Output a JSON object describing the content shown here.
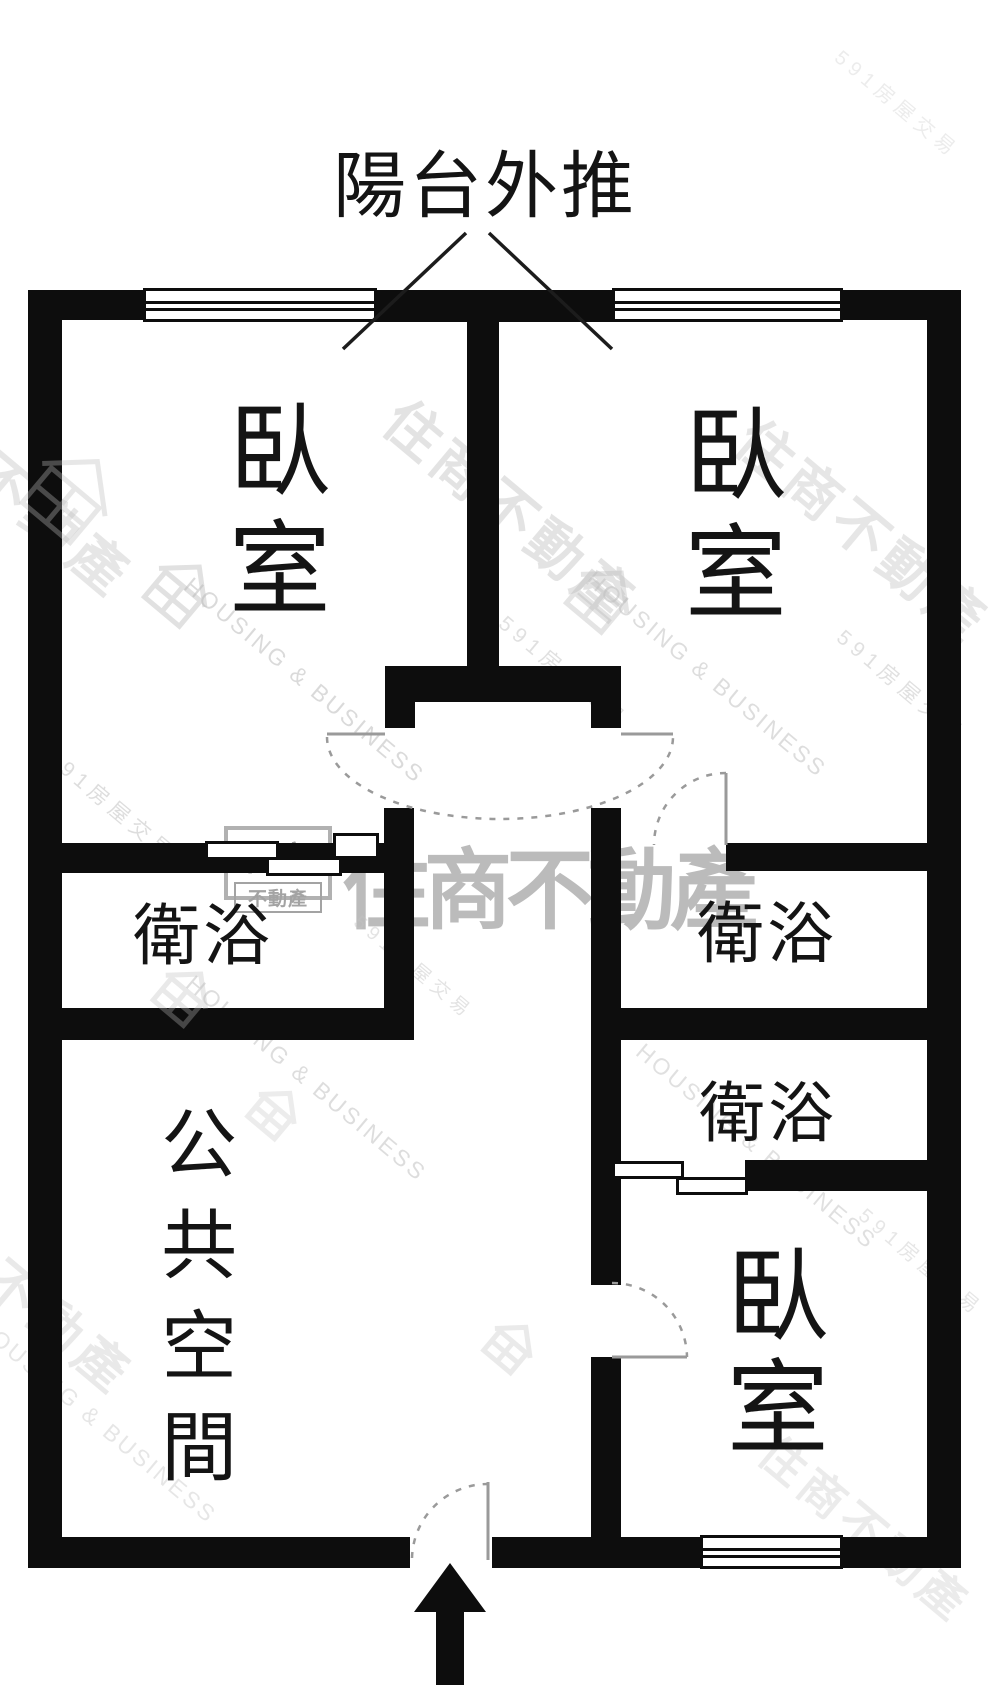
{
  "title": {
    "text": "陽台外推"
  },
  "brand_watermark": {
    "logo_top": "住商",
    "logo_bottom": "不動產",
    "big_text": "住商不動產",
    "company_en": "HOUSING & BUSINESS",
    "portal_text": "591房屋交易",
    "diagonal_text": "住商不動產",
    "gray_color": "#c3c3c3"
  },
  "rooms": {
    "bedroom1": {
      "label": "臥室"
    },
    "bedroom2": {
      "label": "臥室"
    },
    "bedroom3": {
      "label": "臥室"
    },
    "bath_left": {
      "label": "衛浴"
    },
    "bath_right_upper": {
      "label": "衛浴"
    },
    "bath_right_lower": {
      "label": "衛浴"
    },
    "public_space": {
      "label": "公共空間"
    }
  },
  "label_layout": [
    {
      "room": "bedroom1",
      "left": 214,
      "top": 397,
      "size": 102,
      "vertical": true,
      "spacing": 16
    },
    {
      "room": "bedroom2",
      "left": 670,
      "top": 401,
      "size": 102,
      "vertical": true,
      "spacing": 16
    },
    {
      "room": "bedroom3",
      "left": 712,
      "top": 1242,
      "size": 102,
      "vertical": true,
      "spacing": 10
    },
    {
      "room": "bath_left",
      "left": 133,
      "top": 899,
      "size": 67,
      "vertical": false,
      "spacing": 3
    },
    {
      "room": "bath_right_upper",
      "left": 697,
      "top": 897,
      "size": 67,
      "vertical": false,
      "spacing": 3
    },
    {
      "room": "bath_right_lower",
      "left": 699,
      "top": 1077,
      "size": 66,
      "vertical": false,
      "spacing": 3
    },
    {
      "room": "public_space",
      "left": 149,
      "top": 1104,
      "size": 76,
      "vertical": true,
      "spacing": 25
    }
  ],
  "floorplan": {
    "wall_color": "#0d0d0d",
    "walls": [
      {
        "x": 28,
        "y": 290,
        "w": 115,
        "h": 30
      },
      {
        "x": 377,
        "y": 290,
        "w": 235,
        "h": 32
      },
      {
        "x": 843,
        "y": 290,
        "w": 118,
        "h": 30
      },
      {
        "x": 28,
        "y": 290,
        "w": 34,
        "h": 1278
      },
      {
        "x": 927,
        "y": 290,
        "w": 34,
        "h": 1278
      },
      {
        "x": 28,
        "y": 1537,
        "w": 382,
        "h": 31
      },
      {
        "x": 492,
        "y": 1537,
        "w": 208,
        "h": 31
      },
      {
        "x": 843,
        "y": 1537,
        "w": 118,
        "h": 31
      },
      {
        "x": 467,
        "y": 318,
        "w": 32,
        "h": 352
      },
      {
        "x": 385,
        "y": 666,
        "w": 236,
        "h": 36
      },
      {
        "x": 385,
        "y": 700,
        "w": 30,
        "h": 28
      },
      {
        "x": 591,
        "y": 700,
        "w": 30,
        "h": 28
      },
      {
        "x": 62,
        "y": 843,
        "w": 272,
        "h": 30
      },
      {
        "x": 332,
        "y": 843,
        "w": 54,
        "h": 30
      },
      {
        "x": 384,
        "y": 808,
        "w": 30,
        "h": 232
      },
      {
        "x": 62,
        "y": 1008,
        "w": 352,
        "h": 32
      },
      {
        "x": 591,
        "y": 808,
        "w": 30,
        "h": 477
      },
      {
        "x": 591,
        "y": 1357,
        "w": 30,
        "h": 183
      },
      {
        "x": 726,
        "y": 843,
        "w": 201,
        "h": 28
      },
      {
        "x": 591,
        "y": 1008,
        "w": 336,
        "h": 32
      },
      {
        "x": 745,
        "y": 1160,
        "w": 182,
        "h": 31
      }
    ],
    "windows": [
      {
        "x": 143,
        "y": 288,
        "w": 234,
        "h": 34
      },
      {
        "x": 612,
        "y": 288,
        "w": 231,
        "h": 34
      },
      {
        "x": 700,
        "y": 1535,
        "w": 143,
        "h": 34
      }
    ],
    "sliding_panels": [
      {
        "x": 205,
        "y": 841,
        "w": 74,
        "h": 19
      },
      {
        "x": 266,
        "y": 857,
        "w": 76,
        "h": 19
      },
      {
        "x": 333,
        "y": 833,
        "w": 46,
        "h": 26
      },
      {
        "x": 612,
        "y": 1161,
        "w": 72,
        "h": 18
      },
      {
        "x": 676,
        "y": 1177,
        "w": 72,
        "h": 18
      }
    ],
    "door_leaves": [
      {
        "x1": 327,
        "y1": 734,
        "x2": 385,
        "y2": 734
      },
      {
        "x1": 621,
        "y1": 734,
        "x2": 673,
        "y2": 734
      },
      {
        "x1": 726,
        "y1": 773,
        "x2": 726,
        "y2": 845
      },
      {
        "x1": 612,
        "y1": 1357,
        "x2": 687,
        "y2": 1357
      },
      {
        "x1": 488,
        "y1": 1482,
        "x2": 488,
        "y2": 1560
      }
    ],
    "door_arcs": [
      {
        "d": "M327,737 A173,82 0 0 0 673,737"
      },
      {
        "d": "M726,773 A72,72 0 0 0 654,845"
      },
      {
        "d": "M612,1283 A75,75 0 0 1 687,1357"
      },
      {
        "d": "M412,1558 A76,76 0 0 1 488,1484"
      }
    ],
    "leader_lines": [
      {
        "x1": 343,
        "y1": 349,
        "x2": 466,
        "y2": 233
      },
      {
        "x1": 489,
        "y1": 233,
        "x2": 612,
        "y2": 349
      }
    ],
    "entry_arrow_points": "450,1563 486,1612 464,1612 464,1685 436,1685 436,1612 414,1612"
  },
  "watermarks": {
    "texts": [
      {
        "kind": "cjk",
        "left": 420,
        "top": 378,
        "size": 56,
        "rot": 40,
        "op": 0.45
      },
      {
        "kind": "cjk",
        "left": 772,
        "top": 398,
        "size": 56,
        "rot": 40,
        "op": 0.4
      },
      {
        "kind": "cjk",
        "left": -85,
        "top": 352,
        "size": 56,
        "rot": 40,
        "op": 0.4
      },
      {
        "kind": "cjk",
        "left": -70,
        "top": 1165,
        "size": 52,
        "rot": 40,
        "op": 0.35
      },
      {
        "kind": "cjk",
        "left": 788,
        "top": 1418,
        "size": 46,
        "rot": 40,
        "op": 0.32
      },
      {
        "kind": "en",
        "left": 196,
        "top": 572,
        "size": 23,
        "rot": 40,
        "op": 0.6
      },
      {
        "kind": "en",
        "left": 598,
        "top": 566,
        "size": 23,
        "rot": 40,
        "op": 0.55
      },
      {
        "kind": "en",
        "left": 198,
        "top": 970,
        "size": 23,
        "rot": 40,
        "op": 0.55
      },
      {
        "kind": "en",
        "left": 648,
        "top": 1038,
        "size": 23,
        "rot": 40,
        "op": 0.5
      },
      {
        "kind": "en",
        "left": -12,
        "top": 1312,
        "size": 23,
        "rot": 40,
        "op": 0.4
      },
      {
        "kind": "portal",
        "left": 60,
        "top": 742,
        "size": 21,
        "rot": 40,
        "op": 0.55
      },
      {
        "kind": "portal",
        "left": 512,
        "top": 608,
        "size": 21,
        "rot": 40,
        "op": 0.5
      },
      {
        "kind": "portal",
        "left": 850,
        "top": 622,
        "size": 21,
        "rot": 40,
        "op": 0.5
      },
      {
        "kind": "portal",
        "left": 366,
        "top": 908,
        "size": 19,
        "rot": 40,
        "op": 0.45
      },
      {
        "kind": "portal",
        "left": 872,
        "top": 1200,
        "size": 20,
        "rot": 40,
        "op": 0.4
      },
      {
        "kind": "portal",
        "left": 848,
        "top": 42,
        "size": 20,
        "rot": 40,
        "op": 0.3
      }
    ],
    "houses": [
      {
        "x": 150,
        "y": 560,
        "s": 60,
        "rot": 40,
        "op": 0.45
      },
      {
        "x": 572,
        "y": 566,
        "s": 60,
        "rot": 40,
        "op": 0.4
      },
      {
        "x": 30,
        "y": 452,
        "s": 82,
        "rot": 40,
        "op": 0.35
      },
      {
        "x": 158,
        "y": 968,
        "s": 52,
        "rot": 40,
        "op": 0.32
      },
      {
        "x": 488,
        "y": 1322,
        "s": 46,
        "rot": 40,
        "op": 0.3
      },
      {
        "x": 252,
        "y": 1088,
        "s": 46,
        "rot": 40,
        "op": 0.28
      }
    ],
    "logo": {
      "left": 224,
      "top": 826,
      "w": 108,
      "h": 74
    },
    "big_text": {
      "left": 342,
      "top": 820
    }
  }
}
